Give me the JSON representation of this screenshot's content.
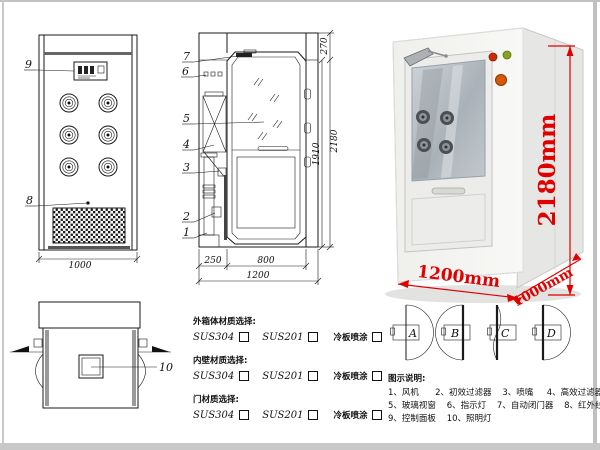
{
  "page": {
    "background": "#ffffff",
    "frame_color": "#c8c8c8",
    "line_color": "#1a1a1a",
    "accent_red": "#e00000"
  },
  "front_view": {
    "callout_9": "9",
    "callout_8": "8",
    "dim_width": "1000"
  },
  "side_view": {
    "callouts": [
      "7",
      "6",
      "5",
      "4",
      "3",
      "2",
      "1"
    ],
    "dims_bottom": [
      "250",
      "800",
      "1200"
    ],
    "dims_right": [
      "270",
      "1910",
      "2180"
    ]
  },
  "top_view": {
    "callout_10": "10"
  },
  "photo": {
    "dim_height": "2180mm",
    "dim_width": "1200mm",
    "dim_depth": "1000mm"
  },
  "materials": {
    "sections": [
      {
        "label": "外箱体材质选择:",
        "options": [
          "SUS304",
          "SUS201",
          "冷板喷涂"
        ]
      },
      {
        "label": "内壁材质选择:",
        "options": [
          "SUS304",
          "SUS201",
          "冷板喷涂"
        ]
      },
      {
        "label": "门材质选择:",
        "options": [
          "SUS304",
          "SUS201",
          "冷板喷涂"
        ]
      }
    ]
  },
  "door_options": {
    "labels": [
      "A",
      "B",
      "C",
      "D"
    ]
  },
  "legend": {
    "title": "图示说明:",
    "lines": [
      "1、风机      2、初效过滤器    3、喷嘴     4、高效过滤器",
      "5、玻璃视窗    6、指示灯    7、自动闭门器    8、红外线感应器",
      "9、控制面板    10、照明灯"
    ]
  }
}
